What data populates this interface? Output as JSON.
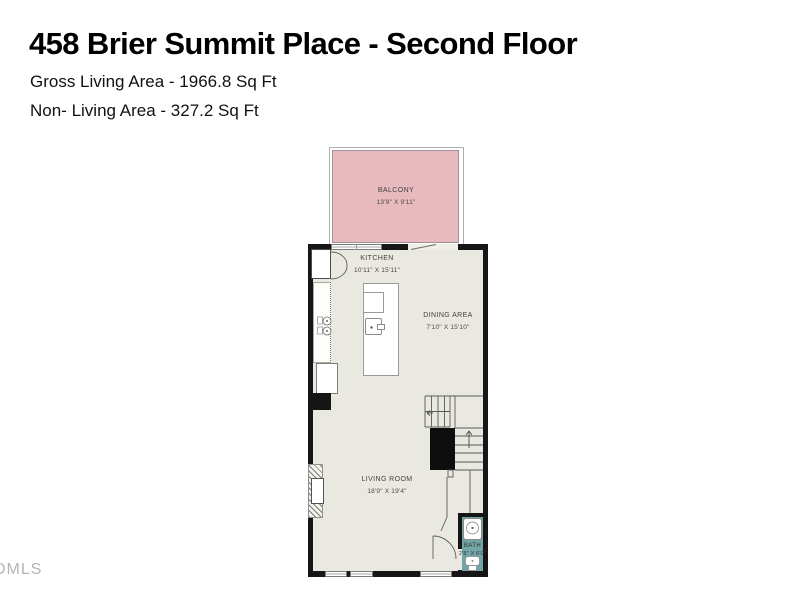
{
  "header": {
    "title": "458 Brier Summit Place - Second Floor",
    "gross_living_area": "Gross Living Area - 1966.8 Sq Ft",
    "non_living_area": "Non- Living Area - 327.2 Sq Ft"
  },
  "watermark": "DMLS",
  "floorplan": {
    "rooms": {
      "balcony": {
        "name": "BALCONY",
        "dims": "13'9\" X 9'11\""
      },
      "kitchen": {
        "name": "KITCHEN",
        "dims": "10'11\" X 15'11\""
      },
      "dining": {
        "name": "DINING AREA",
        "dims": "7'10\" X 15'10\""
      },
      "living": {
        "name": "LIVING ROOM",
        "dims": "18'9\" X 19'4\""
      },
      "bath": {
        "name": "BATH",
        "dims": "2'8\" X 6'0\""
      }
    },
    "colors": {
      "balcony_fill": "#e6babe",
      "bath_fill": "#72a5a7",
      "floor_fill": "#eae9e1",
      "wall": "#161616",
      "label_text": "#45413e"
    }
  }
}
